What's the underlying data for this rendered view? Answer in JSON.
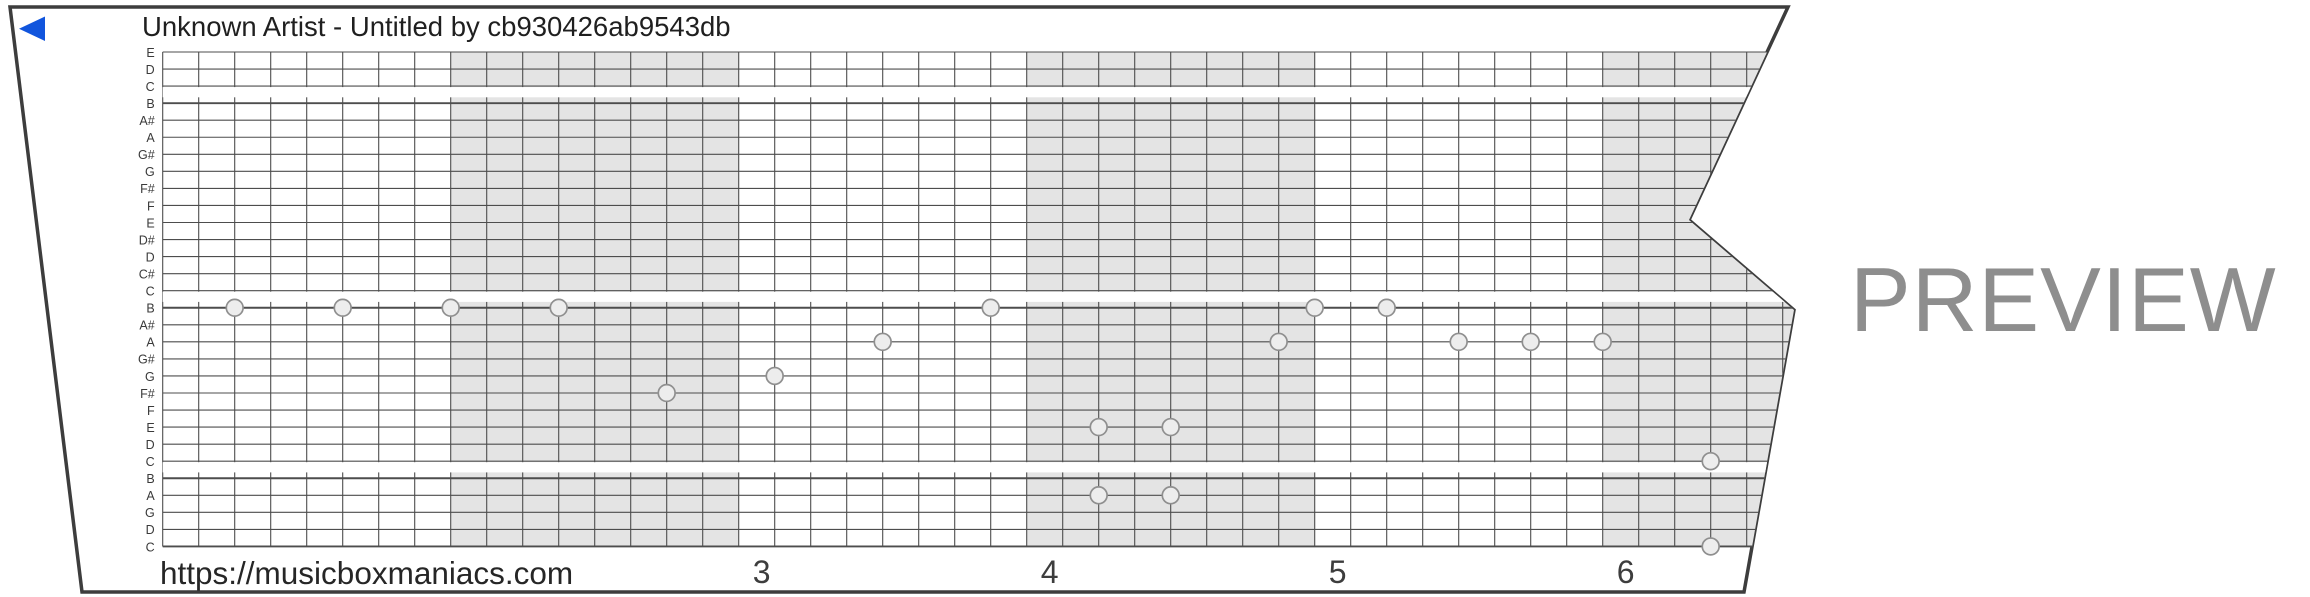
{
  "header": {
    "title": "Unknown Artist - Untitled by cb930426ab9543db"
  },
  "watermark": {
    "url": "https://musicboxmaniacs.com",
    "preview_label": "PREVIEW"
  },
  "chart_data": {
    "type": "piano-roll",
    "title": "Unknown Artist - Untitled by cb930426ab9543db",
    "row_labels_top_to_bottom": [
      "E",
      "D",
      "C",
      "B",
      "A#",
      "A",
      "G#",
      "G",
      "F#",
      "F",
      "E",
      "D#",
      "D",
      "C#",
      "C",
      "B",
      "A#",
      "A",
      "G#",
      "G",
      "F#",
      "F",
      "E",
      "D",
      "C",
      "B",
      "A",
      "G",
      "D",
      "C"
    ],
    "c_line_indices": [
      2,
      14,
      24,
      29
    ],
    "octave_thick_line_indices": [
      3,
      15,
      25,
      29
    ],
    "columns_per_measure": 8,
    "measure_numbers_shown": [
      "3",
      "4",
      "5",
      "6"
    ],
    "shaded_measure_ordinals": [
      2,
      4,
      6
    ],
    "notes": [
      {
        "col": 2,
        "line": 15,
        "pitch": "B"
      },
      {
        "col": 5,
        "line": 15,
        "pitch": "B"
      },
      {
        "col": 8,
        "line": 15,
        "pitch": "B"
      },
      {
        "col": 11,
        "line": 15,
        "pitch": "B"
      },
      {
        "col": 14,
        "line": 20,
        "pitch": "F#"
      },
      {
        "col": 17,
        "line": 19,
        "pitch": "G"
      },
      {
        "col": 20,
        "line": 17,
        "pitch": "A"
      },
      {
        "col": 23,
        "line": 15,
        "pitch": "B"
      },
      {
        "col": 26,
        "line": 22,
        "pitch": "E"
      },
      {
        "col": 28,
        "line": 22,
        "pitch": "E"
      },
      {
        "col": 26,
        "line": 26,
        "pitch": "A"
      },
      {
        "col": 28,
        "line": 26,
        "pitch": "A"
      },
      {
        "col": 31,
        "line": 17,
        "pitch": "A"
      },
      {
        "col": 32,
        "line": 15,
        "pitch": "B"
      },
      {
        "col": 34,
        "line": 15,
        "pitch": "B"
      },
      {
        "col": 36,
        "line": 17,
        "pitch": "A"
      },
      {
        "col": 38,
        "line": 17,
        "pitch": "A"
      },
      {
        "col": 40,
        "line": 17,
        "pitch": "A"
      },
      {
        "col": 43,
        "line": 24,
        "pitch": "C"
      },
      {
        "col": 43,
        "line": 29,
        "pitch": "C"
      }
    ],
    "colors": {
      "strip_fill": "#ffffff",
      "strip_border": "#3d3d3d",
      "measure_shade": "#e4e4e4",
      "grid_line": "#4d4d4d",
      "note_fill": "#ededed",
      "note_stroke": "#8f8f8f",
      "text": "#1f1f1f",
      "label_text": "#3a3a3a",
      "preview_text": "#8e8e8e",
      "accent_blue": "#1155dd"
    }
  }
}
